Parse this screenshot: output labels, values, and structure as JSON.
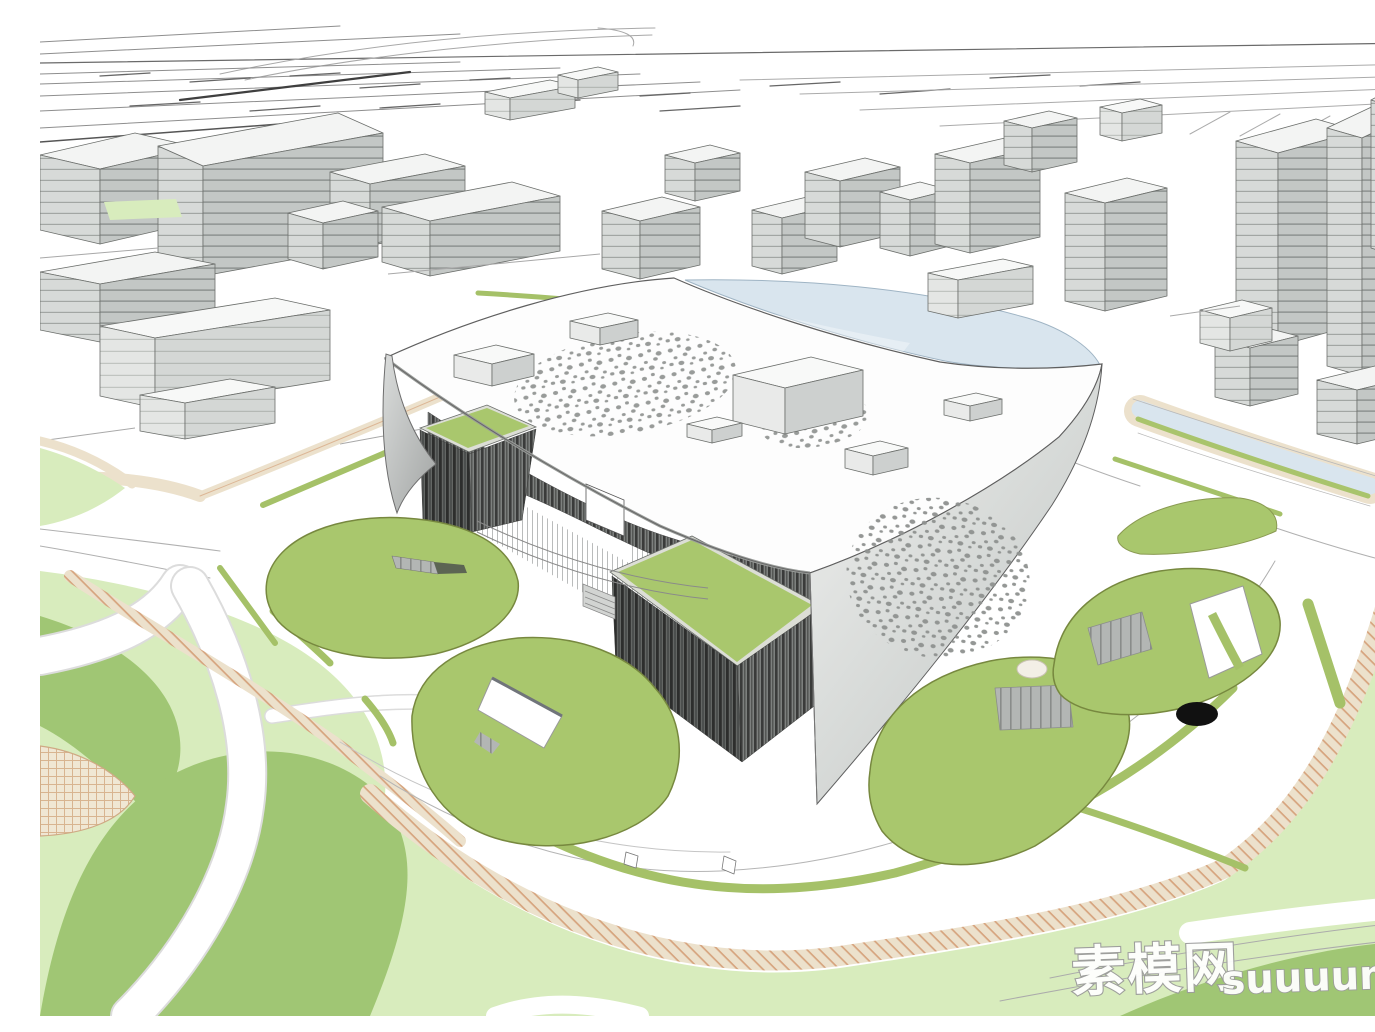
{
  "meta": {
    "type": "architectural-3d-rendering",
    "subject": "white canopy cultural building with green mounds in an urban master plan"
  },
  "watermark": {
    "cjk": "素模网",
    "latin": "suuuum.com"
  },
  "palette": {
    "mound_green": "#a9c76d",
    "mound_edge": "#77883f",
    "lawn_pale": "#d8ecbd",
    "park_green": "#a0c674",
    "water_blue": "#d9e5ee",
    "sand_tan": "#ece1cc",
    "sand_line": "#d6a47e",
    "louver_dark": "#3a3b3a",
    "facade_grey": "#c4c8c6",
    "canopy_white": "#fdfdfd",
    "line_grey": "#6f6f6f",
    "hole_black": "#111111"
  }
}
